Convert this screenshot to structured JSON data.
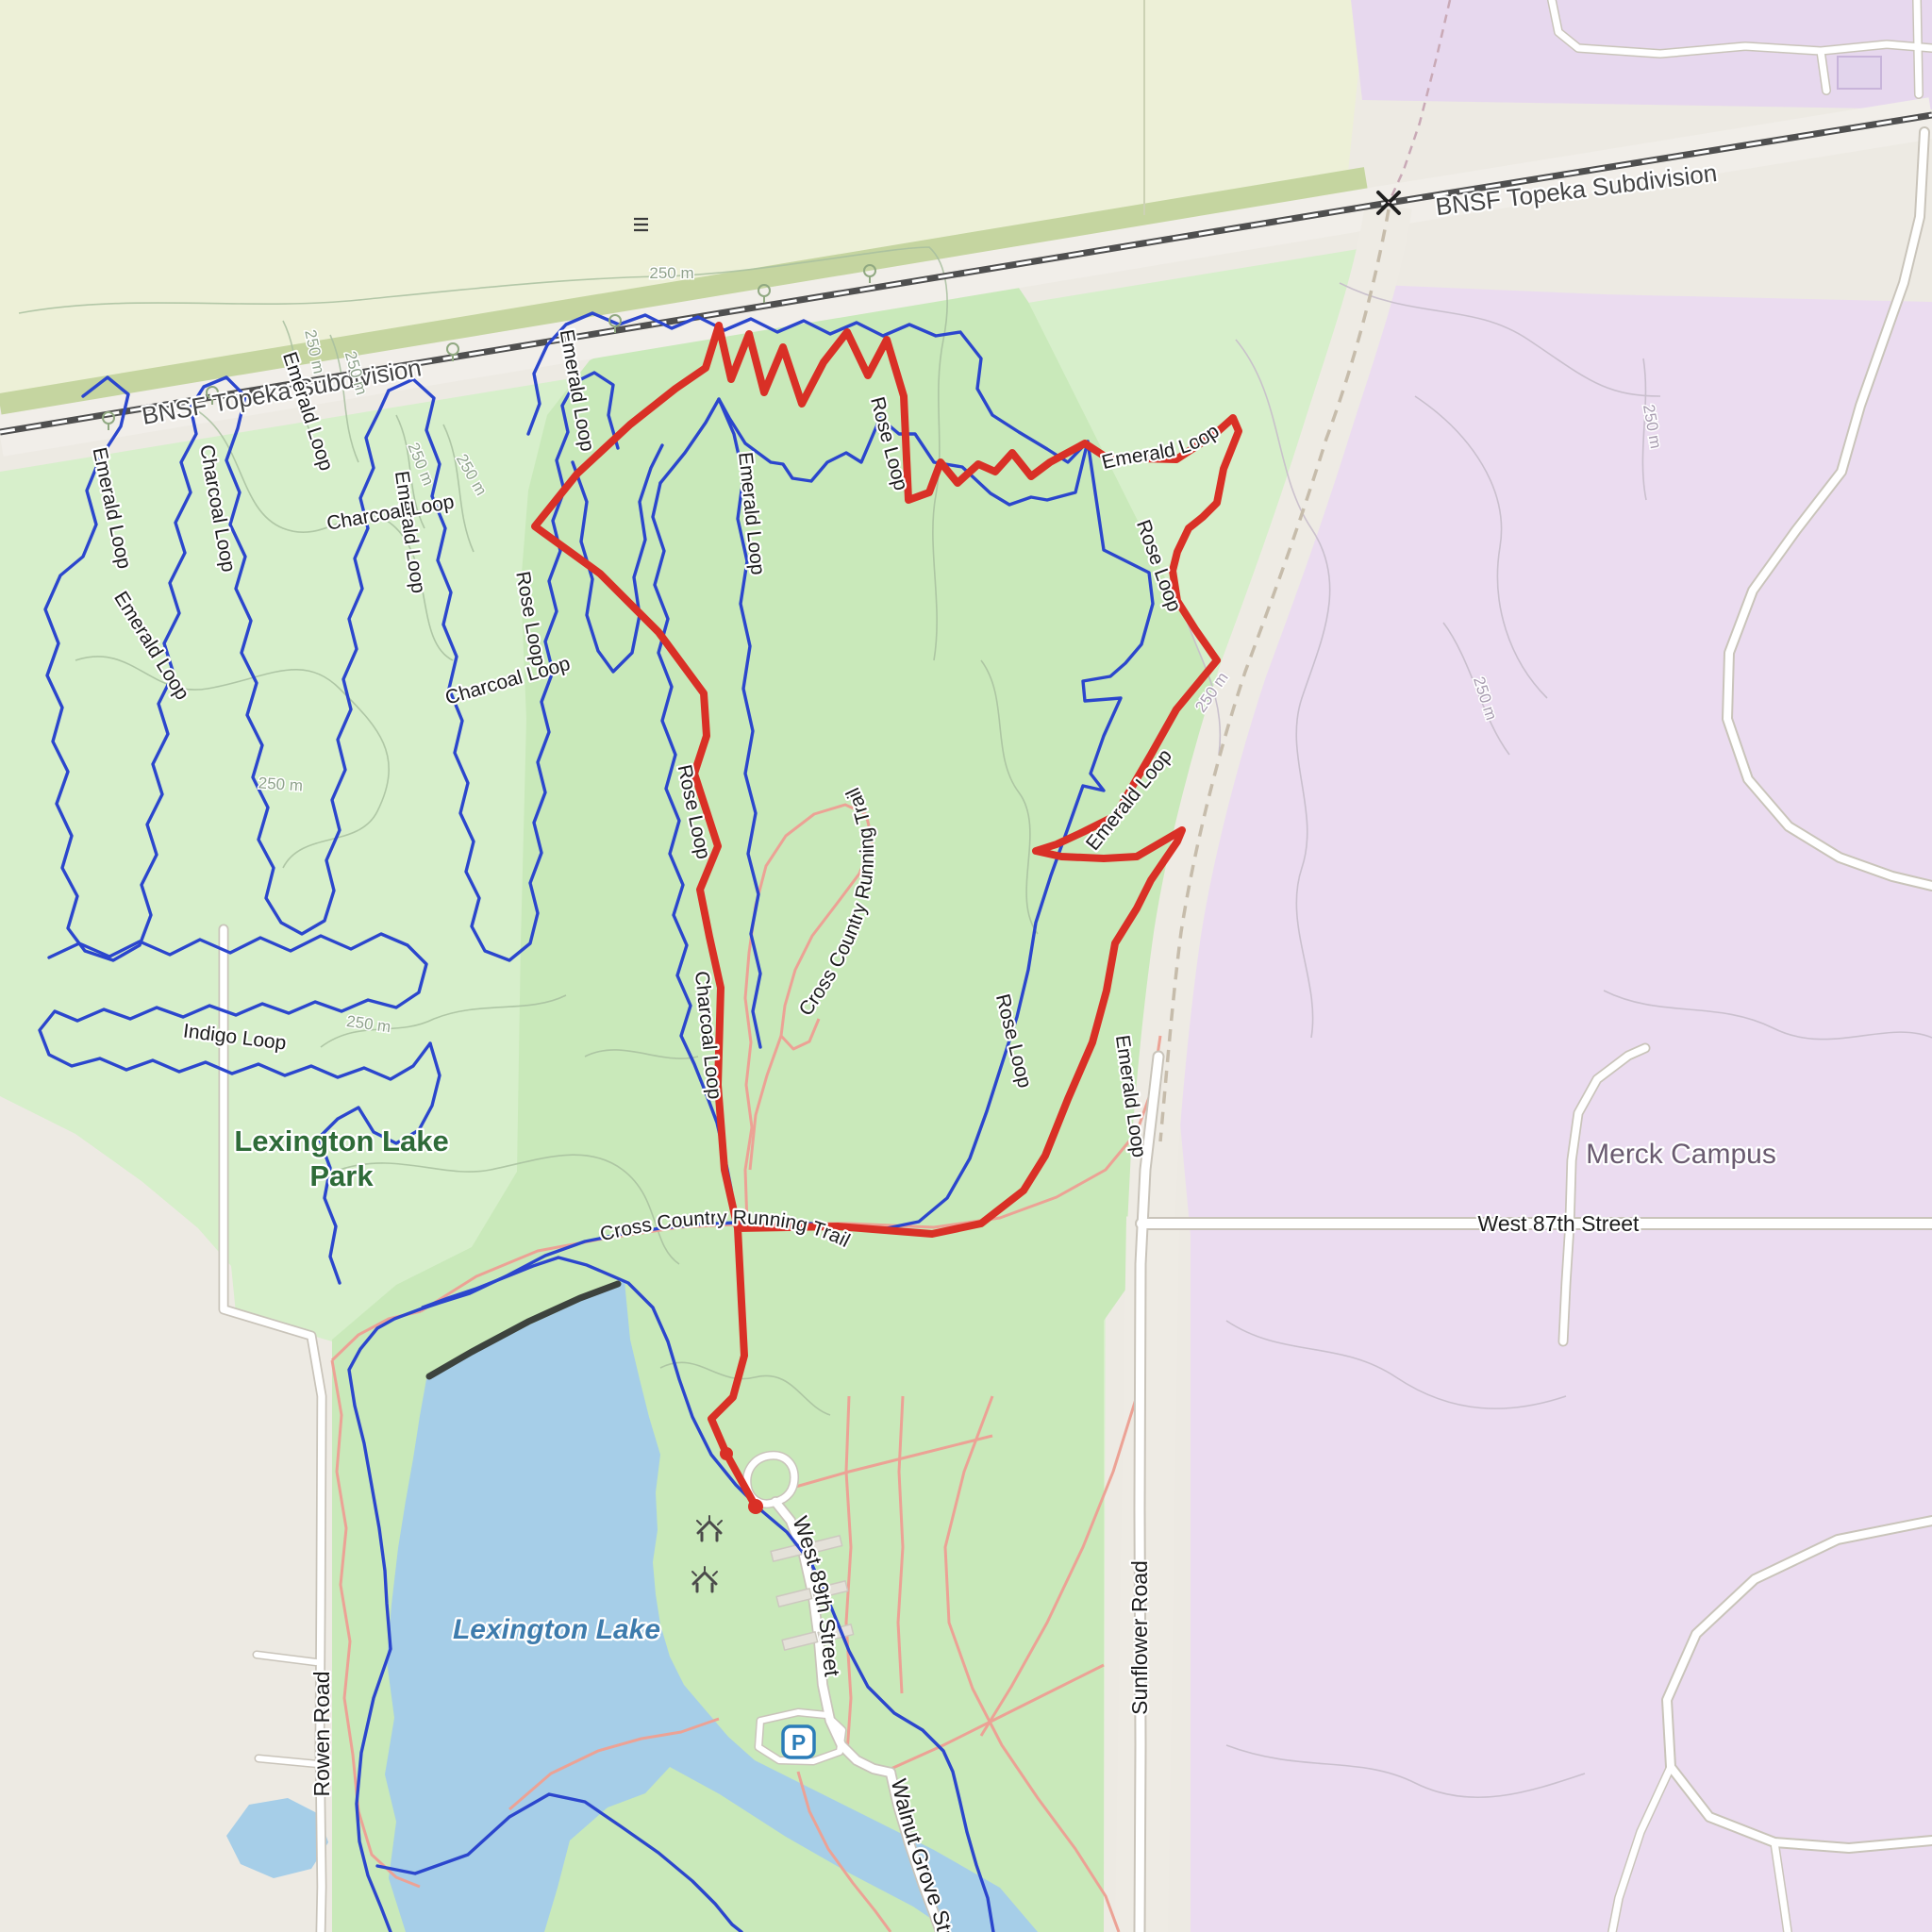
{
  "map": {
    "railway_label": "BNSF Topeka Subdivision",
    "places": {
      "park_line1": "Lexington Lake",
      "park_line2": "Park",
      "lake": "Lexington Lake",
      "campus": "Merck Campus"
    },
    "roads": {
      "rowen": "Rowen Road",
      "west87": "West 87th Street",
      "west89": "West 89th Street",
      "sunflower": "Sunflower Road",
      "walnut_grove": "Walnut Grove Street"
    },
    "trails": {
      "emerald": "Emerald Loop",
      "charcoal": "Charcoal Loop",
      "rose": "Rose Loop",
      "indigo": "Indigo Loop",
      "cross_country": "Cross Country Running Trail"
    },
    "contour_label": "250 m",
    "parking_symbol": "P",
    "colors": {
      "park_green": "#d7efcb",
      "forest_green": "#c9e9ba",
      "farmland": "#edf0d7",
      "campus_pink": "#ebdcf0",
      "water_blue": "#a6cee8",
      "trail_blue": "#2b46cd",
      "gps_track_red": "#d93026",
      "xc_trail_salmon": "#eca295"
    }
  }
}
